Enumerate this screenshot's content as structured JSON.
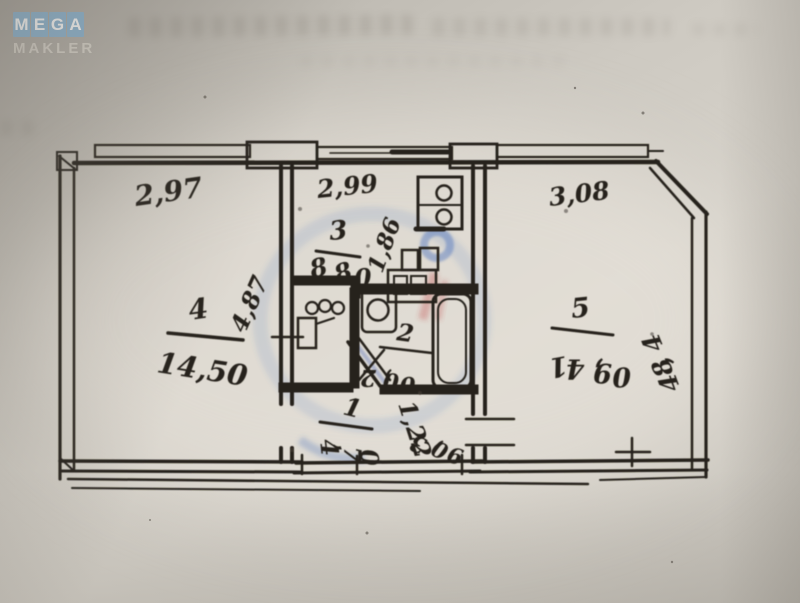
{
  "logo": {
    "tiles": [
      "M",
      "E",
      "G",
      "A"
    ],
    "subtitle": "MAKLER",
    "tile_color": "#8db6d3",
    "letter_color": "#fdfefe",
    "subtitle_color": "#dad6cd"
  },
  "page": {
    "background_color": "#cdc9c1",
    "ink_color": "#26231d"
  },
  "watermark": {
    "blue": "#5076be",
    "red": "#be4040"
  },
  "plan": {
    "top_dims": {
      "room4": "2,97",
      "kitchen": "2,99",
      "room5": "3,08"
    },
    "room4": {
      "number": "4",
      "area": "14,50",
      "side_dim": "4,87"
    },
    "kitchen": {
      "number": "3",
      "area": "8,80",
      "inner_dim": "1,86"
    },
    "room5": {
      "number": "5",
      "area": "14,90",
      "side_dim": "4,84"
    },
    "bathroom": {
      "number": "2",
      "area": "2,00"
    },
    "hallway": {
      "number": "1",
      "area": "4,70",
      "dim_a": "1,22",
      "dim_b": "3,09"
    }
  }
}
